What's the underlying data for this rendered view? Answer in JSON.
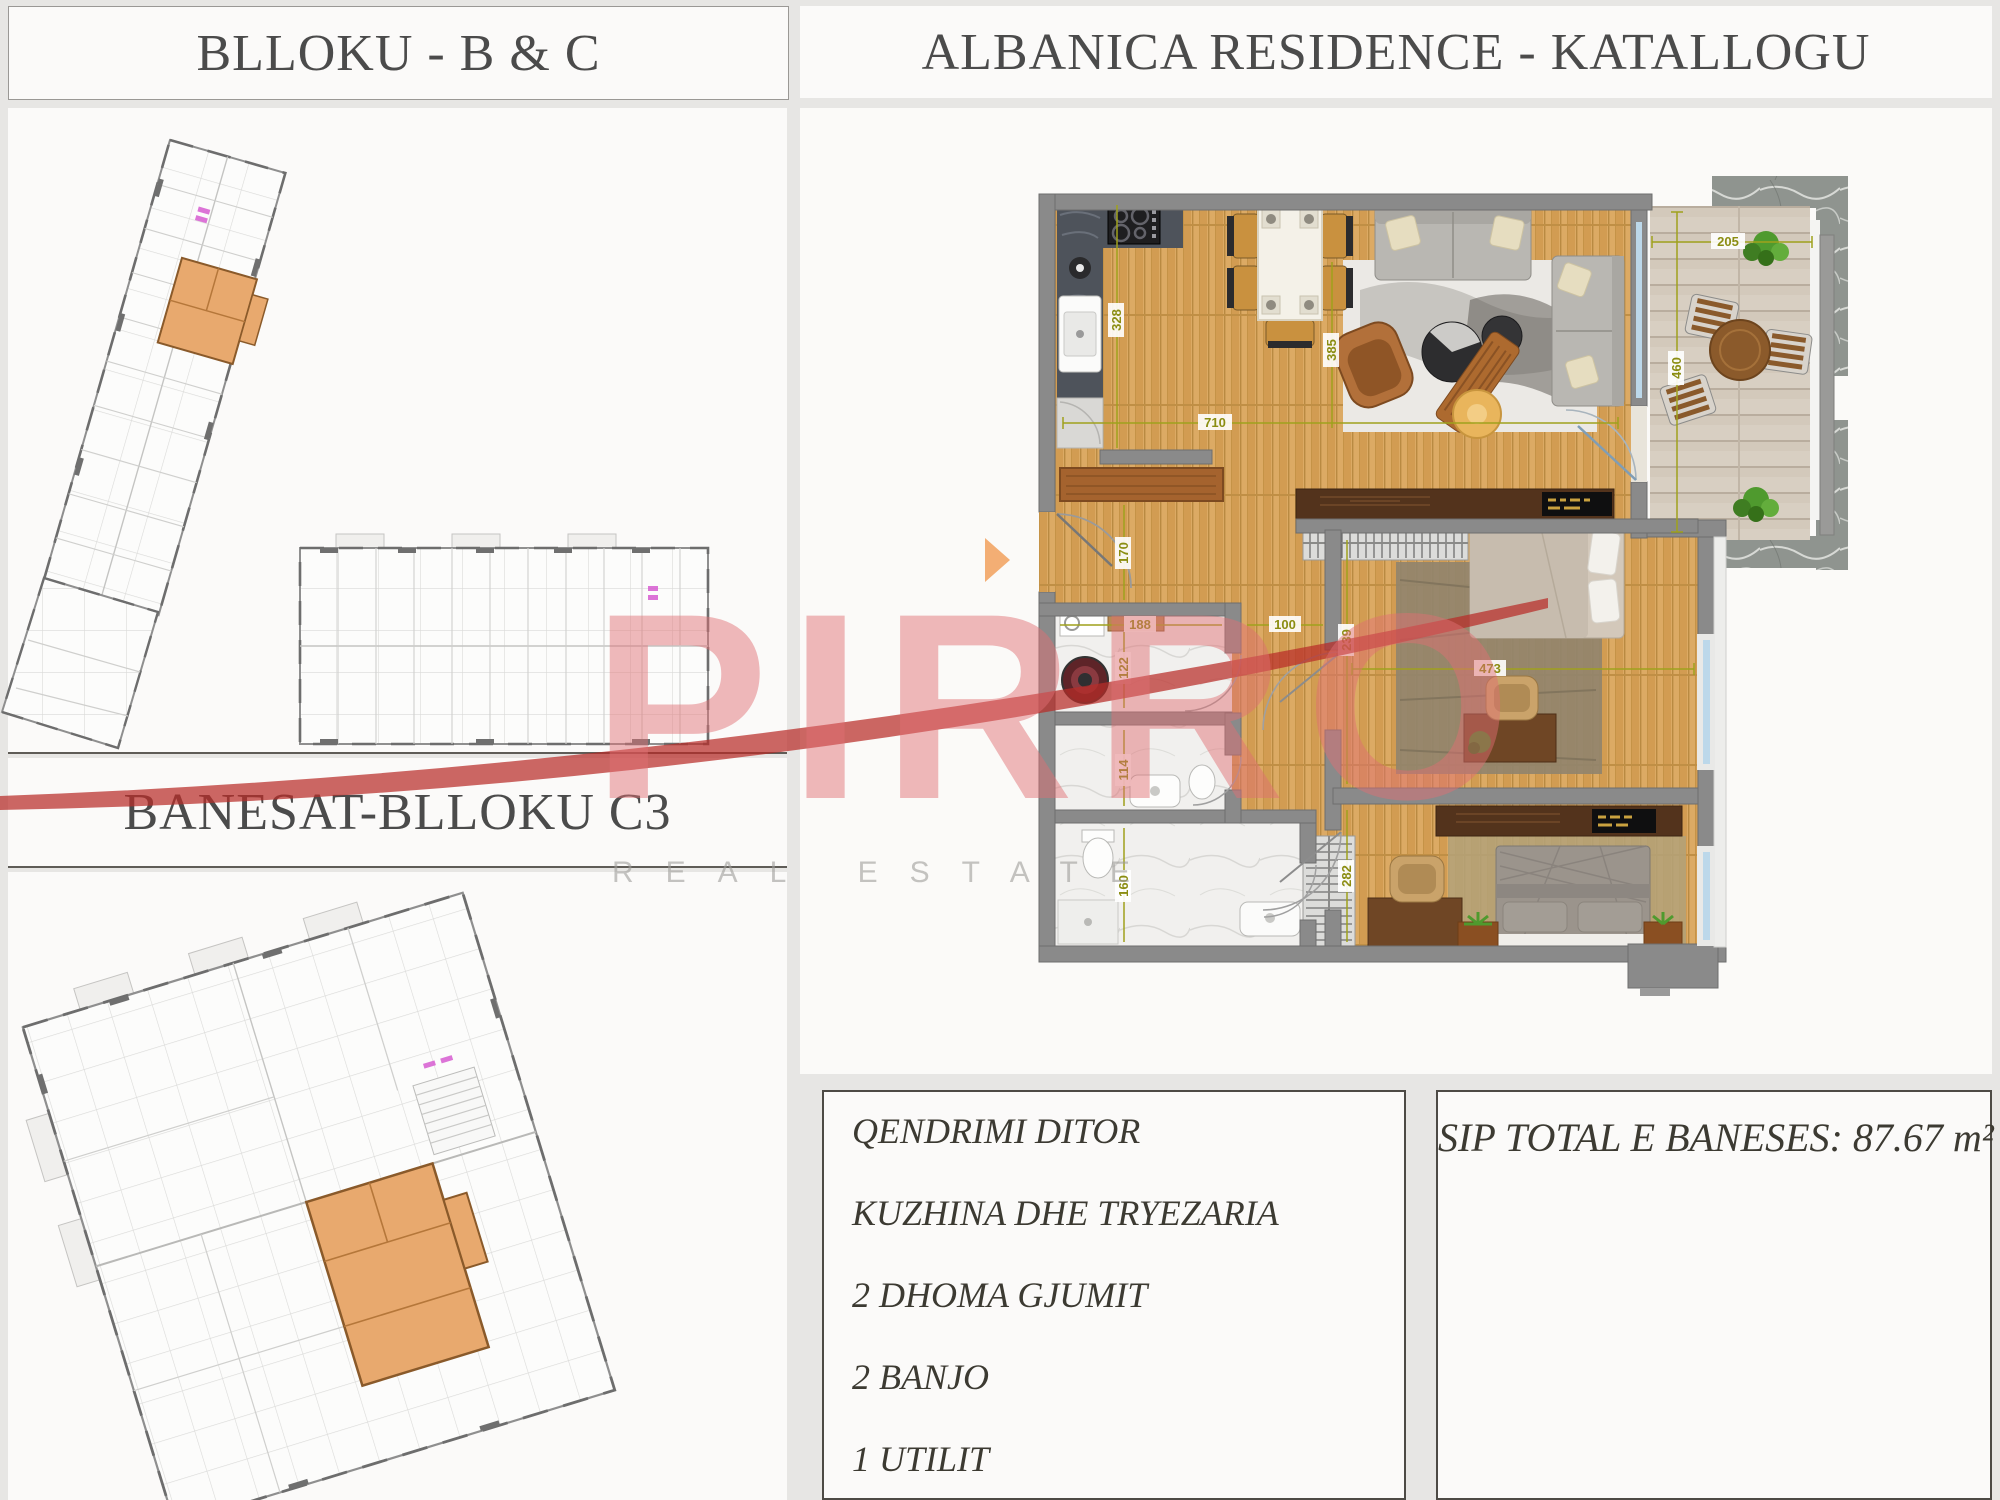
{
  "titles": {
    "left_top": "BLLOKU - B & C",
    "right": "ALBANICA RESIDENCE - KATALLOGU",
    "left_mid": "BANESAT-BLLOKU C3"
  },
  "details": {
    "features": [
      "QENDRIMI DITOR",
      "KUZHINA DHE TRYEZARIA",
      "2 DHOMA GJUMIT",
      "2 BANJO",
      "1 UTILIT"
    ],
    "area_total": "SIP TOTAL E BANESES: 87.67 m²"
  },
  "watermark": {
    "brand": "PIRRO",
    "tagline": "REAL ESTATE"
  },
  "plan": {
    "dims": {
      "d205": "205",
      "d460": "460",
      "d328": "328",
      "d385": "385",
      "d710": "710",
      "d170": "170",
      "d188": "188",
      "d100": "100",
      "d122": "122",
      "d114": "114",
      "d160": "160",
      "d239": "239",
      "d473": "473",
      "d282": "282"
    }
  },
  "colors": {
    "highlight_orange": "#E8A96E",
    "watermark_red": "#E2787B",
    "dimension_olive": "#9FA11C",
    "wall_gray": "#8A8A8A",
    "entry_arrow": "#F3AE74"
  }
}
